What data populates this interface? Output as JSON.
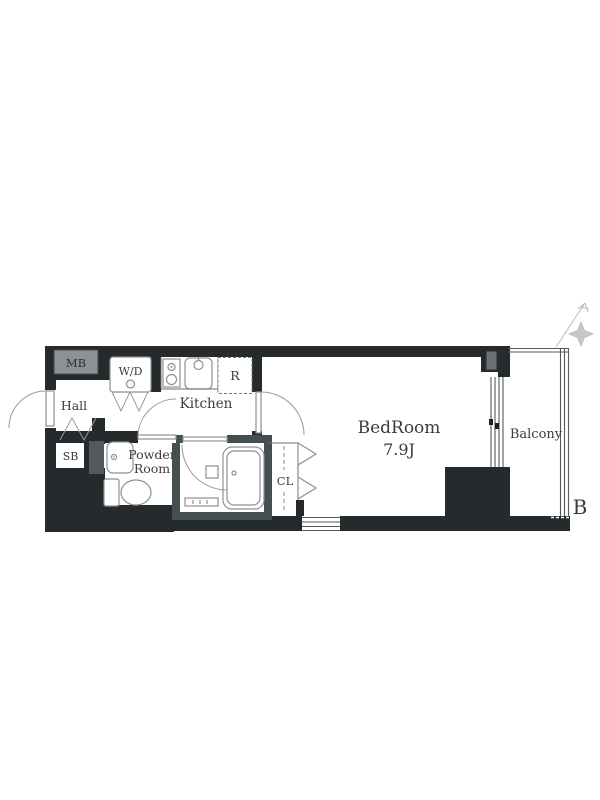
{
  "floorplan": {
    "title": "apartment-floor-plan",
    "rooms": {
      "hall": {
        "label": "Hall"
      },
      "kitchen": {
        "label": "Kitchen"
      },
      "bedroom": {
        "label": "BedRoom",
        "size": "7.9J"
      },
      "powder_room": {
        "label_line1": "Powder",
        "label_line2": "Room"
      },
      "closet": {
        "label": "CL"
      },
      "balcony": {
        "label": "Balcony"
      }
    },
    "fixtures": {
      "meter_box": {
        "label": "MB"
      },
      "washer_dryer": {
        "label": "W/D"
      },
      "refrigerator_space": {
        "label": "R"
      },
      "shoe_box": {
        "label": "SB"
      }
    },
    "annotations": {
      "section_mark": "B"
    },
    "colors": {
      "wall": "#252a2c",
      "bath-wall": "#454f52",
      "meter-box-fill": "#8d9194",
      "pipe-space-fill": "#53595c",
      "pipe-space-top-fill": "#6b7276",
      "line": "#8f8f8f",
      "arc": "#9a9a9a",
      "text": "#3b3b3b"
    }
  }
}
